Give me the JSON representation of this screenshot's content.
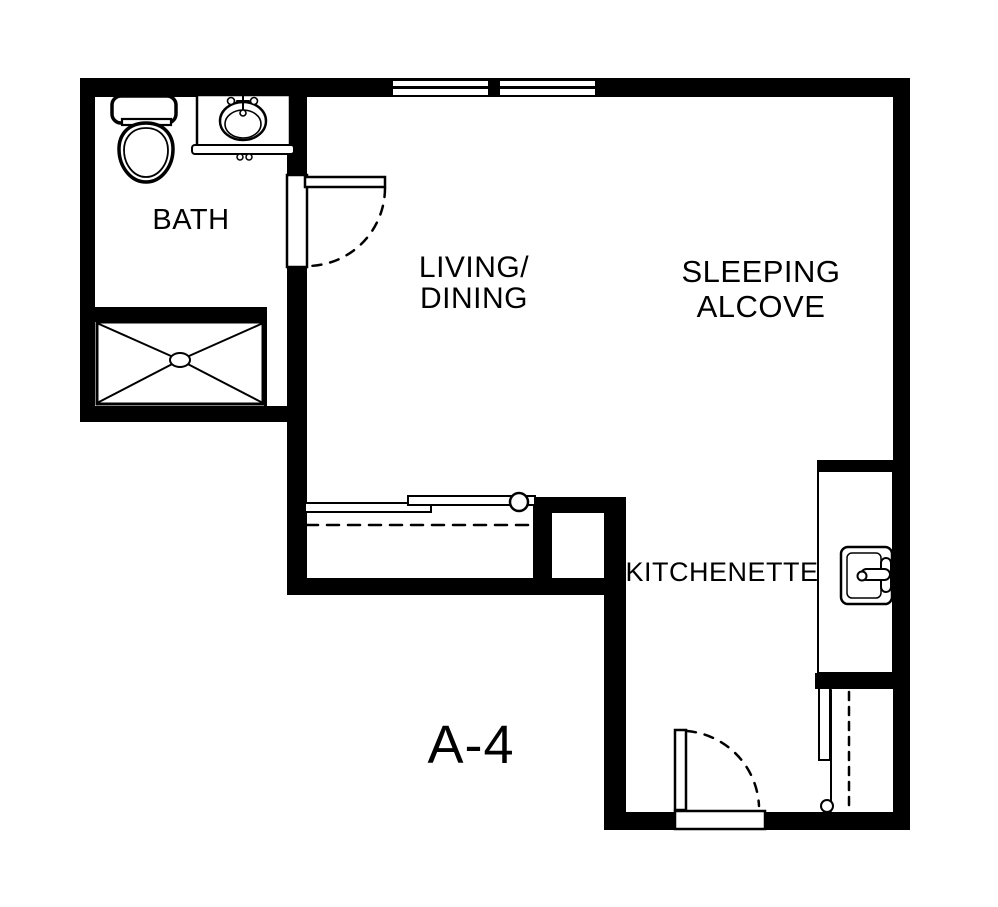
{
  "plan": {
    "unit_label": "A-4",
    "labels": {
      "bath": "BATH",
      "living_line1": "LIVING/",
      "living_line2": "DINING",
      "sleeping_line1": "SLEEPING",
      "sleeping_line2": "ALCOVE",
      "kitchenette": "KITCHENETTE"
    },
    "colors": {
      "wall": "#000000",
      "fixture_line": "#000000",
      "floor": "#ffffff",
      "text": "#000000"
    },
    "symbols": [
      "toilet-icon",
      "vanity-sink-icon",
      "shower-icon",
      "bath-swing-door-icon",
      "window-icon",
      "window-icon",
      "sliding-closet-door-icon",
      "duct-chase",
      "kitchen-sink-icon",
      "kitchen-counter",
      "wardrobe-icon",
      "entry-swing-door-icon"
    ]
  }
}
